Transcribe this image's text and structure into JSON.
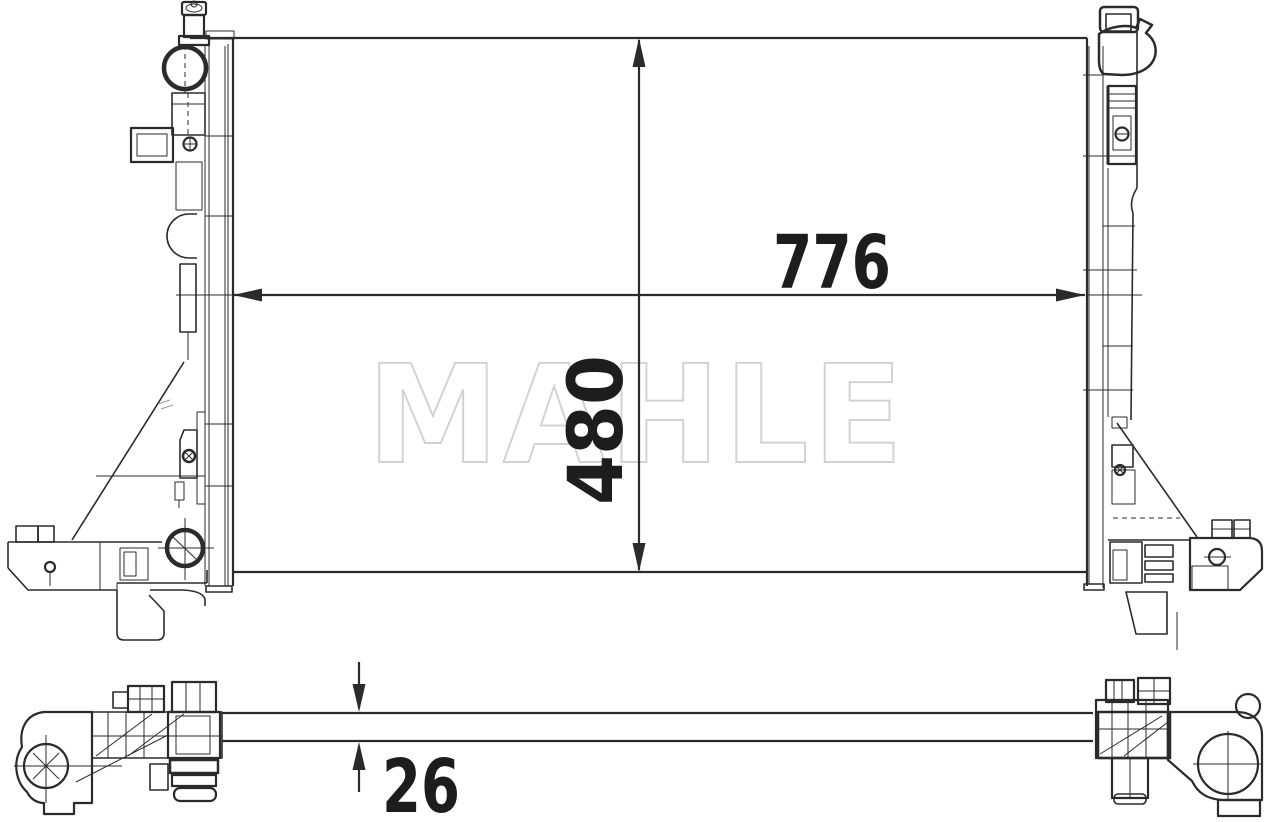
{
  "drawing": {
    "watermark_text": "MAHLE",
    "dimensions": {
      "width_mm": "776",
      "height_mm": "480",
      "depth_mm": "26"
    },
    "colors": {
      "background": "#ffffff",
      "line": "#2b2b2b",
      "dimension_text": "#1d1d1d",
      "watermark": "#d2d2d2"
    }
  }
}
